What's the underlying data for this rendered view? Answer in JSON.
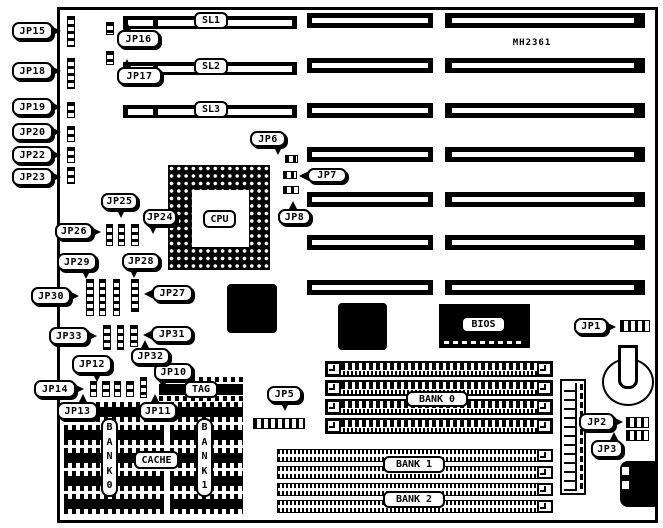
{
  "board": {
    "model": "MH2361"
  },
  "slots": {
    "sl1": "SL1",
    "sl2": "SL2",
    "sl3": "SL3"
  },
  "chips": {
    "cpu": "CPU",
    "bios": "BIOS",
    "tag": "TAG",
    "cache": "CACHE",
    "cache_bank_left": "BANK0",
    "cache_bank_right": "BANK1"
  },
  "memory_banks": {
    "bank0": "BANK 0",
    "bank1": "BANK 1",
    "bank2": "BANK 2"
  },
  "callouts": [
    {
      "id": "jp1",
      "label": "JP1"
    },
    {
      "id": "jp2",
      "label": "JP2"
    },
    {
      "id": "jp3",
      "label": "JP3"
    },
    {
      "id": "jp5",
      "label": "JP5"
    },
    {
      "id": "jp6",
      "label": "JP6"
    },
    {
      "id": "jp7",
      "label": "JP7"
    },
    {
      "id": "jp8",
      "label": "JP8"
    },
    {
      "id": "jp10",
      "label": "JP10"
    },
    {
      "id": "jp11",
      "label": "JP11"
    },
    {
      "id": "jp12",
      "label": "JP12"
    },
    {
      "id": "jp13",
      "label": "JP13"
    },
    {
      "id": "jp14",
      "label": "JP14"
    },
    {
      "id": "jp15",
      "label": "JP15"
    },
    {
      "id": "jp16",
      "label": "JP16"
    },
    {
      "id": "jp17",
      "label": "JP17"
    },
    {
      "id": "jp18",
      "label": "JP18"
    },
    {
      "id": "jp19",
      "label": "JP19"
    },
    {
      "id": "jp20",
      "label": "JP20"
    },
    {
      "id": "jp22",
      "label": "JP22"
    },
    {
      "id": "jp23",
      "label": "JP23"
    },
    {
      "id": "jp24",
      "label": "JP24"
    },
    {
      "id": "jp25",
      "label": "JP25"
    },
    {
      "id": "jp26",
      "label": "JP26"
    },
    {
      "id": "jp27",
      "label": "JP27"
    },
    {
      "id": "jp28",
      "label": "JP28"
    },
    {
      "id": "jp29",
      "label": "JP29"
    },
    {
      "id": "jp30",
      "label": "JP30"
    },
    {
      "id": "jp31",
      "label": "JP31"
    },
    {
      "id": "jp32",
      "label": "JP32"
    },
    {
      "id": "jp33",
      "label": "JP33"
    }
  ]
}
